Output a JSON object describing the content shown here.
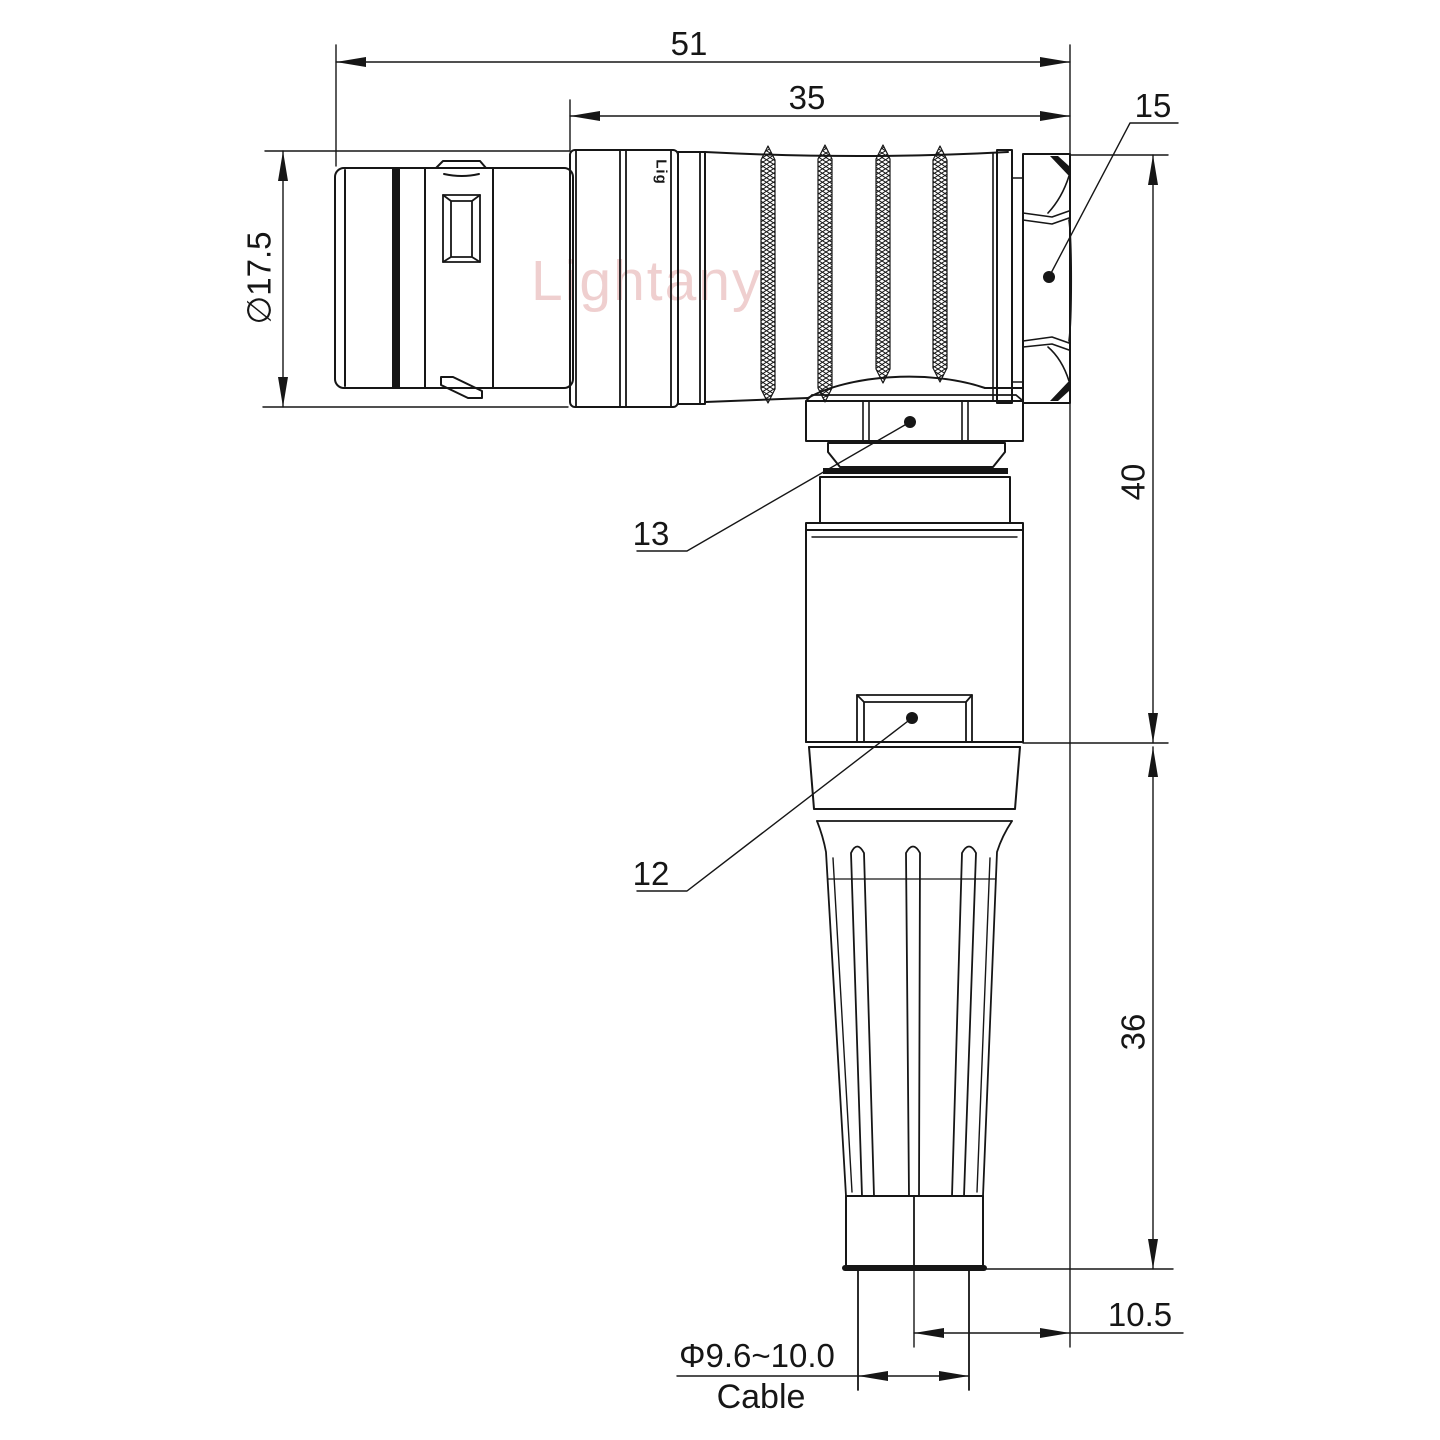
{
  "watermark": {
    "text": "Lightany"
  },
  "connector": {
    "engraving": "Lig"
  },
  "dimensions": {
    "overall_length": "51",
    "rear_body_length": "35",
    "hex_nut_callout": "15",
    "upper_height": "40",
    "lower_height": "36",
    "cable_offset": "10.5",
    "shell_diameter": "∅17.5",
    "cable_diameter": "Φ9.6~10.0",
    "cable_label": "Cable",
    "callout_coupling_nut": "13",
    "callout_housing": "12"
  },
  "colors": {
    "line": "#161616",
    "watermark": "#e2a9a9",
    "background": "#ffffff"
  }
}
